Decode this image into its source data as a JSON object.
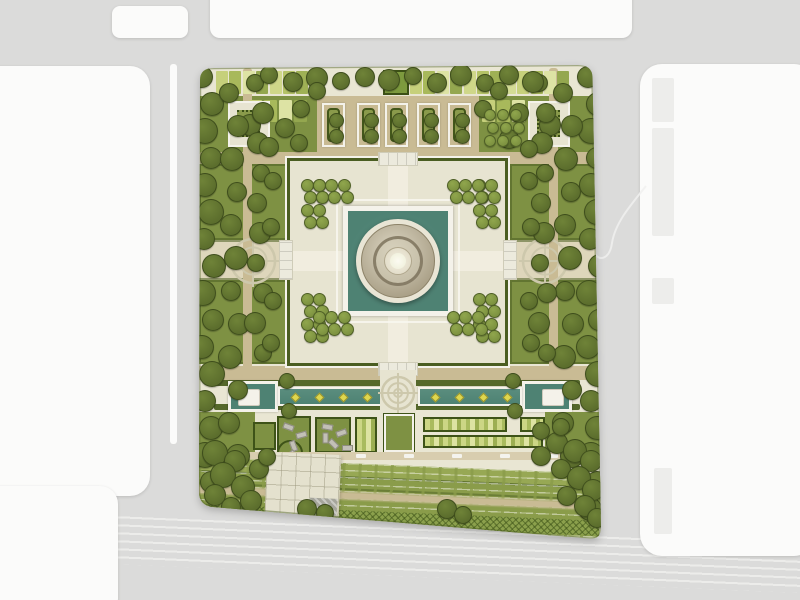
{
  "title": "formal-garden-site-plan",
  "colors": {
    "road": "#dbdbda",
    "block": "#fbfbfa",
    "building": "#ededeb",
    "laneLine": "#eeeeec",
    "siteBase": "#e9e6d3",
    "platform": "#e7e4d1",
    "pathTan": "#c9bb94",
    "pathLight": "#d8cdaf",
    "axisPlaza": "#ded6bb",
    "lawn": "#7e9143",
    "lawnBright": "#8a9c4a",
    "lawnLight": "#97a854",
    "hedge": "#4c6023",
    "hedgeDark": "#3e5318",
    "treeDark": "#5c6e2d",
    "treeDarkHi": "#6f8338",
    "treeSmall": "#7d9240",
    "treeSmallHi": "#90a64d",
    "pool": "#4e8273",
    "poolHi": "#5a8d7e",
    "frameWhite": "#f4f2ea",
    "bedFill": "#c8ba92",
    "domeLight": "#e9e5d5",
    "domeMid": "#a89e85",
    "domeCore": "#f4f1e3",
    "fountain": "#ded74f",
    "medallion": "#cdc8ac",
    "bench": "#c2c0b6",
    "plazaPave": "#e4e1ce",
    "patches": [
      "#c6d07b",
      "#a8b95b",
      "#dde3a4",
      "#94a74f",
      "#cfd789",
      "#b4c266",
      "#9fb155",
      "#d4dc95"
    ]
  },
  "surroundings": {
    "blocks": [
      {
        "x": 112,
        "y": 6,
        "w": 76,
        "h": 32,
        "r": 8
      },
      {
        "x": 210,
        "y": -14,
        "w": 422,
        "h": 52,
        "r": 10
      },
      {
        "x": -24,
        "y": 66,
        "w": 174,
        "h": 430,
        "r": 20
      },
      {
        "x": -24,
        "y": 486,
        "w": 142,
        "h": 130,
        "r": 18
      },
      {
        "x": 640,
        "y": 64,
        "w": 176,
        "h": 492,
        "r": 22
      }
    ],
    "buildings": [
      {
        "x": 652,
        "y": 78,
        "w": 22,
        "h": 44
      },
      {
        "x": 652,
        "y": 128,
        "w": 22,
        "h": 108
      },
      {
        "x": 652,
        "y": 278,
        "w": 22,
        "h": 26
      },
      {
        "x": 654,
        "y": 468,
        "w": 18,
        "h": 66
      }
    ]
  },
  "site": {
    "patch_rows": [
      {
        "x0": 216,
        "y": 71,
        "w": 12,
        "h": 23,
        "step": 13.4,
        "count": 8
      },
      {
        "x0": 410,
        "y": 71,
        "w": 12,
        "h": 23,
        "step": 13.4,
        "count": 12
      },
      {
        "x0": 249,
        "y": 100,
        "w": 13,
        "h": 22,
        "step": 15,
        "count": 4
      },
      {
        "x0": 482,
        "y": 100,
        "w": 13,
        "h": 22,
        "step": 15,
        "count": 3
      }
    ],
    "north_beds": {
      "xs": [
        322,
        357,
        385,
        417,
        448
      ],
      "tree_r": 6.5,
      "tree_cy": [
        117,
        133
      ]
    },
    "pavilions": [
      {
        "x": 230,
        "y": 103
      },
      {
        "x": 530,
        "y": 103
      }
    ],
    "steps": [
      {
        "x": 378,
        "y": 152,
        "w": 40,
        "h": 14,
        "dir": "h"
      },
      {
        "x": 378,
        "y": 362,
        "w": 40,
        "h": 14,
        "dir": "h"
      },
      {
        "x": 279,
        "y": 240,
        "w": 14,
        "h": 40,
        "dir": "v"
      },
      {
        "x": 503,
        "y": 240,
        "w": 14,
        "h": 40,
        "dir": "v"
      }
    ],
    "pools": {
      "hedge_strips": [
        [
          214,
          380,
          168
        ],
        [
          414,
          380,
          166
        ],
        [
          214,
          404,
          168
        ],
        [
          414,
          404,
          166
        ]
      ],
      "west_basin": {
        "x": 228,
        "y": 381
      },
      "east_basin": {
        "x": 522,
        "y": 381
      },
      "west_channel": {
        "x": 278,
        "y": 387
      },
      "east_channel": {
        "x": 418,
        "y": 387
      },
      "islands": [
        [
          238,
          389
        ],
        [
          542,
          389
        ]
      ],
      "fountains": {
        "y": 396,
        "xs": [
          294,
          318,
          342,
          366,
          434,
          458,
          482,
          506
        ]
      }
    },
    "plots": [
      {
        "x": 199,
        "y": 412,
        "w": 56,
        "h": 48,
        "kind": "plain"
      },
      {
        "x": 545,
        "y": 412,
        "w": 56,
        "h": 46,
        "kind": "plain"
      },
      {
        "x": 253,
        "y": 422,
        "w": 23,
        "h": 28,
        "kind": "lawn"
      },
      {
        "x": 277,
        "y": 416,
        "w": 34,
        "h": 38,
        "kind": "lawn",
        "bulge": [
          290,
          453,
          13
        ]
      },
      {
        "x": 315,
        "y": 417,
        "w": 36,
        "h": 36,
        "kind": "lawn"
      },
      {
        "x": 355,
        "y": 417,
        "w": 22,
        "h": 36,
        "kind": "stripes"
      },
      {
        "x": 384,
        "y": 414,
        "w": 30,
        "h": 38,
        "kind": "lawn-framed"
      },
      {
        "x": 423,
        "y": 417,
        "w": 84,
        "h": 15,
        "kind": "stripes"
      },
      {
        "x": 520,
        "y": 417,
        "w": 25,
        "h": 15,
        "kind": "stripes"
      },
      {
        "x": 423,
        "y": 435,
        "w": 120,
        "h": 13,
        "kind": "stripes"
      }
    ],
    "benches": [
      [
        283,
        424,
        20
      ],
      [
        296,
        432,
        -15
      ],
      [
        288,
        443,
        70
      ],
      [
        285,
        452,
        -40
      ],
      [
        322,
        424,
        10
      ],
      [
        336,
        430,
        -20
      ],
      [
        328,
        441,
        45
      ],
      [
        342,
        445,
        0
      ],
      [
        320,
        435,
        90
      ]
    ],
    "path_dashes": {
      "y": 454,
      "xs": [
        212,
        260,
        308,
        356,
        404,
        452,
        500,
        548
      ]
    },
    "medallions": [
      {
        "cx": 253,
        "cy": 261,
        "r": 22
      },
      {
        "cx": 545,
        "cy": 261,
        "r": 22
      },
      {
        "cx": 398,
        "cy": 393,
        "r": 16
      }
    ]
  },
  "trees": {
    "rows": [
      {
        "axis": "v",
        "x": 207,
        "from": 76,
        "to": 500,
        "step": 27,
        "r": 11,
        "jit": 6,
        "kind": "dark"
      },
      {
        "axis": "v",
        "x": 233,
        "from": 92,
        "to": 462,
        "step": 33,
        "r": 10,
        "jit": 5,
        "kind": "dark"
      },
      {
        "axis": "v",
        "x": 258,
        "from": 82,
        "to": 360,
        "step": 30,
        "r": 9,
        "jit": 4,
        "kind": "dark"
      },
      {
        "axis": "v",
        "x": 593,
        "from": 76,
        "to": 520,
        "step": 27,
        "r": 11,
        "jit": 6,
        "kind": "dark"
      },
      {
        "axis": "v",
        "x": 567,
        "from": 92,
        "to": 470,
        "step": 33,
        "r": 10,
        "jit": 5,
        "kind": "dark"
      },
      {
        "axis": "v",
        "x": 542,
        "from": 82,
        "to": 360,
        "step": 30,
        "r": 9,
        "jit": 4,
        "kind": "dark"
      },
      {
        "axis": "h",
        "y": 78,
        "from": 268,
        "to": 532,
        "step": 24,
        "r": 9,
        "jit": 4,
        "kind": "dark"
      }
    ],
    "singles": [
      [
        262,
        112,
        10
      ],
      [
        284,
        127,
        9
      ],
      [
        268,
        146,
        9
      ],
      [
        298,
        142,
        8
      ],
      [
        300,
        108,
        8
      ],
      [
        316,
        90,
        8
      ],
      [
        518,
        112,
        9
      ],
      [
        508,
        138,
        9
      ],
      [
        528,
        148,
        8
      ],
      [
        498,
        90,
        8
      ],
      [
        482,
        108,
        8
      ],
      [
        272,
        180,
        8
      ],
      [
        270,
        226,
        8
      ],
      [
        272,
        300,
        8
      ],
      [
        270,
        342,
        8
      ],
      [
        528,
        180,
        8
      ],
      [
        530,
        226,
        8
      ],
      [
        528,
        300,
        8
      ],
      [
        530,
        342,
        8
      ],
      [
        286,
        380,
        7
      ],
      [
        288,
        410,
        7
      ],
      [
        512,
        380,
        7
      ],
      [
        514,
        410,
        7
      ],
      [
        214,
        452,
        12
      ],
      [
        234,
        460,
        10
      ],
      [
        222,
        474,
        12
      ],
      [
        242,
        486,
        11
      ],
      [
        258,
        468,
        9
      ],
      [
        214,
        494,
        10
      ],
      [
        250,
        500,
        10
      ],
      [
        266,
        456,
        8
      ],
      [
        230,
        506,
        9
      ],
      [
        556,
        442,
        10
      ],
      [
        574,
        450,
        11
      ],
      [
        590,
        460,
        10
      ],
      [
        560,
        468,
        9
      ],
      [
        578,
        477,
        11
      ],
      [
        592,
        489,
        10
      ],
      [
        566,
        495,
        9
      ],
      [
        584,
        505,
        10
      ],
      [
        596,
        517,
        9
      ],
      [
        540,
        455,
        9
      ],
      [
        306,
        508,
        9
      ],
      [
        324,
        512,
        8
      ],
      [
        446,
        508,
        9
      ],
      [
        462,
        514,
        8
      ],
      [
        540,
        430,
        8
      ],
      [
        560,
        426,
        8
      ]
    ],
    "clusters": [
      {
        "x": 306,
        "y": 184,
        "cols": 2,
        "rows": 4,
        "step": 12.5,
        "r": 5.5
      },
      {
        "x": 478,
        "y": 184,
        "cols": 2,
        "rows": 4,
        "step": 12.5,
        "r": 5.5
      },
      {
        "x": 306,
        "y": 298,
        "cols": 2,
        "rows": 4,
        "step": 12.5,
        "r": 5.5
      },
      {
        "x": 478,
        "y": 298,
        "cols": 2,
        "rows": 4,
        "step": 12.5,
        "r": 5.5
      },
      {
        "x": 318,
        "y": 184,
        "cols": 3,
        "rows": 2,
        "step": 12.5,
        "r": 5.5
      },
      {
        "x": 452,
        "y": 184,
        "cols": 3,
        "rows": 2,
        "step": 12.5,
        "r": 5.5
      },
      {
        "x": 318,
        "y": 316,
        "cols": 3,
        "rows": 2,
        "step": 12.5,
        "r": 5.5
      },
      {
        "x": 452,
        "y": 316,
        "cols": 3,
        "rows": 2,
        "step": 12.5,
        "r": 5.5
      },
      {
        "x": 489,
        "y": 114,
        "cols": 3,
        "rows": 3,
        "step": 13,
        "r": 5
      }
    ]
  }
}
